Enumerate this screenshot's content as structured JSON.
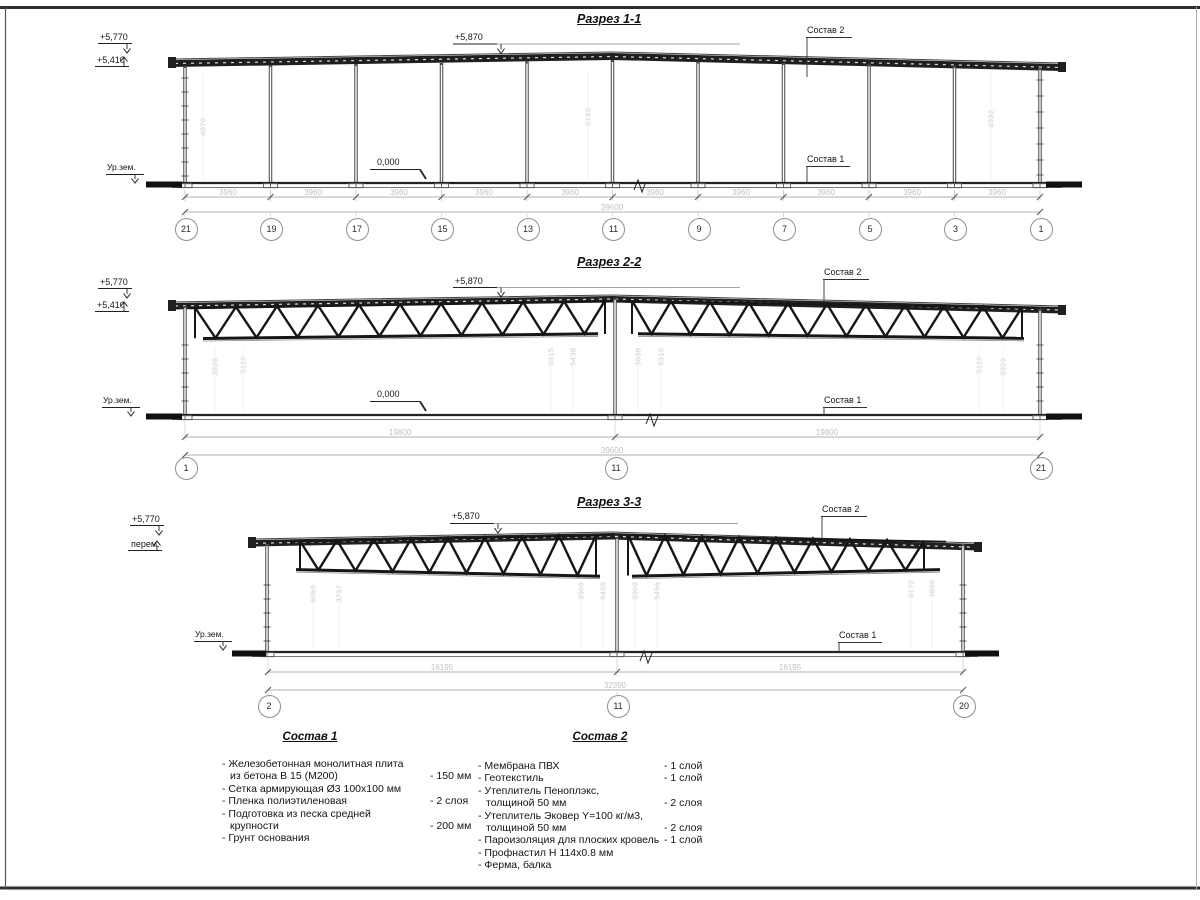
{
  "colors": {
    "line": "#3a3a3a",
    "heavy": "#1f1f1f",
    "faint": "#cfcfcf",
    "dim_text": "#c2c2c2"
  },
  "sections": [
    {
      "title": "Разрез 1-1",
      "elev_top": "+5,770",
      "elev_bot": "+5,410",
      "elev_mid": "+5,870",
      "ground": "Ур.зем.",
      "zero": "0,000",
      "layer2": "Состав 2",
      "layer1": "Состав 1",
      "bay_dim": "3960",
      "total_dim": "39600",
      "bubbles": [
        "21",
        "19",
        "17",
        "15",
        "13",
        "11",
        "9",
        "7",
        "5",
        "3",
        "1"
      ],
      "col_dims": [
        "4970",
        "5195",
        "4932"
      ]
    },
    {
      "title": "Разрез 2-2",
      "elev_top": "+5,770",
      "elev_bot": "+5,410",
      "elev_mid": "+5,870",
      "ground": "Ур.зем.",
      "zero": "0,000",
      "layer2": "Состав 2",
      "layer1": "Состав 1",
      "span_dim": "19800",
      "total_dim": "39600",
      "bubbles": [
        "1",
        "11",
        "21"
      ],
      "col_dims": [
        "3529",
        "5110",
        "5315",
        "5438",
        "3838",
        "5315",
        "5110",
        "3929"
      ]
    },
    {
      "title": "Разрез 3-3",
      "elev_top": "+5,770",
      "elev_bot": "перем.",
      "elev_mid": "+5,870",
      "ground": "Ур.зем.",
      "layer2": "Состав 2",
      "layer1": "Состав 1",
      "span_dim": "16195",
      "total_dim": "32390",
      "bubbles": [
        "2",
        "11",
        "20"
      ],
      "col_dims": [
        "5059",
        "3737",
        "3909",
        "5455",
        "3909",
        "5455",
        "5172",
        "3859"
      ]
    }
  ],
  "spec1": {
    "title": "Состав 1",
    "items": [
      {
        "l1": "- Железобетонная  монолитная плита",
        "l2": "из бетона В 15 (М200)",
        "v": "- 150 мм"
      },
      {
        "l1": "- Сетка армирующая Ø3 100х100 мм"
      },
      {
        "l1": "- Пленка полиэтиленовая",
        "v": "- 2 слоя"
      },
      {
        "l1": "- Подготовка из песка средней",
        "l2": "крупности",
        "v": "- 200 мм"
      },
      {
        "l1": "- Грунт основания"
      }
    ]
  },
  "spec2": {
    "title": "Состав 2",
    "items": [
      {
        "l1": "- Мембрана ПВХ",
        "v": "- 1 слой"
      },
      {
        "l1": "- Геотекстиль",
        "v": "- 1 слой"
      },
      {
        "l1": "- Утеплитель Пеноплэкс,",
        "l2": "толщиной 50 мм",
        "v": "- 2 слоя"
      },
      {
        "l1": "- Утеплитель Эковер Y=100 кг/м3,",
        "l2": "толщиной 50 мм",
        "v": "- 2 слоя"
      },
      {
        "l1": "- Пароизоляция для плоских кровель",
        "v": "- 1 слой"
      },
      {
        "l1": "- Профнастил Н 114х0.8 мм"
      },
      {
        "l1": "- Ферма, балка"
      }
    ]
  }
}
